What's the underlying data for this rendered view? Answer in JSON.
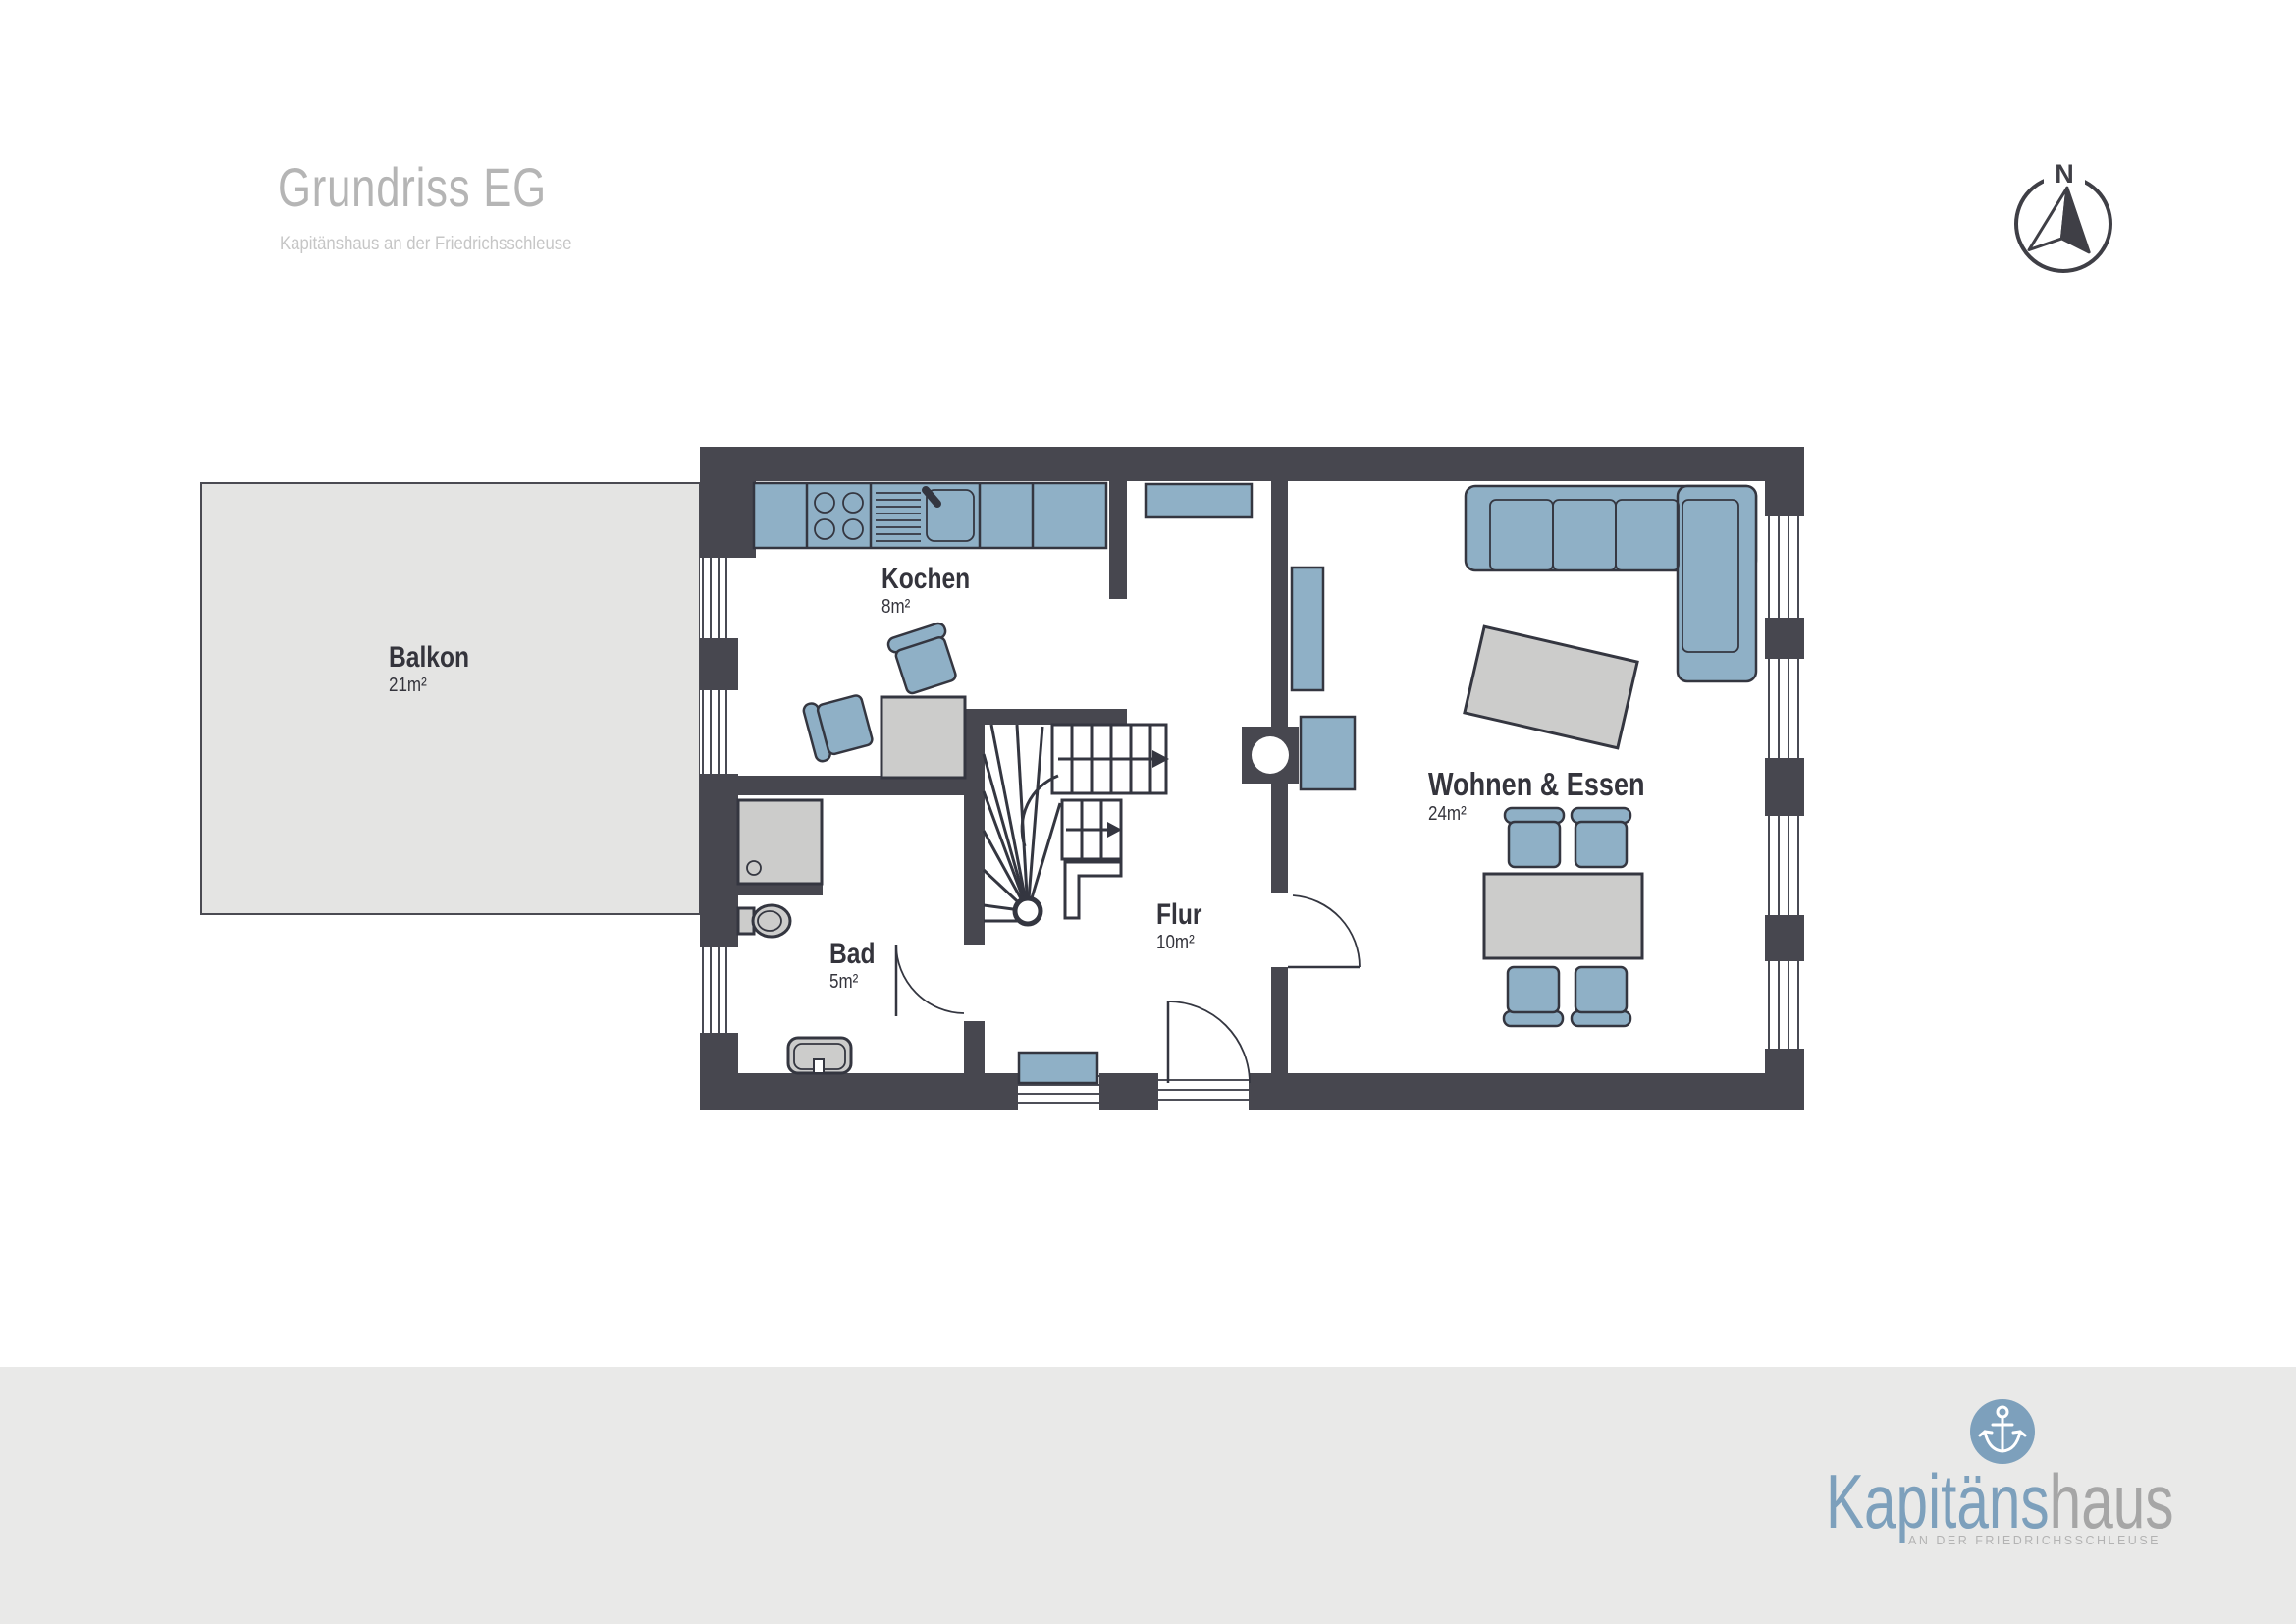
{
  "page": {
    "title": "Grundriss EG",
    "subtitle": "Kapitänshaus an der Friedrichsschleuse"
  },
  "compass": {
    "label": "N"
  },
  "rooms": {
    "balkon": {
      "name": "Balkon",
      "area": "21m²"
    },
    "kochen": {
      "name": "Kochen",
      "area": "8m²"
    },
    "bad": {
      "name": "Bad",
      "area": "5m²"
    },
    "flur": {
      "name": "Flur",
      "area": "10m²"
    },
    "wohnen": {
      "name": "Wohnen & Essen",
      "area": "24m²"
    }
  },
  "footer": {
    "brand_part1": "Kapitäns",
    "brand_part2": "haus",
    "tagline": "AN DER FRIEDRICHSSCHLEUSE"
  },
  "colors": {
    "wall": "#47474f",
    "furniture_blue": "#8fb0c6",
    "furniture_gray": "#cccccb",
    "outline": "#343640",
    "balcony": "#e4e4e3",
    "footer_bg": "#e9e9e8",
    "brand_blue": "#7da0bc",
    "brand_gray": "#a6a6a6",
    "title_gray": "#b5b5b5",
    "subtitle_gray": "#c6c6c6",
    "label": "#34343c"
  }
}
